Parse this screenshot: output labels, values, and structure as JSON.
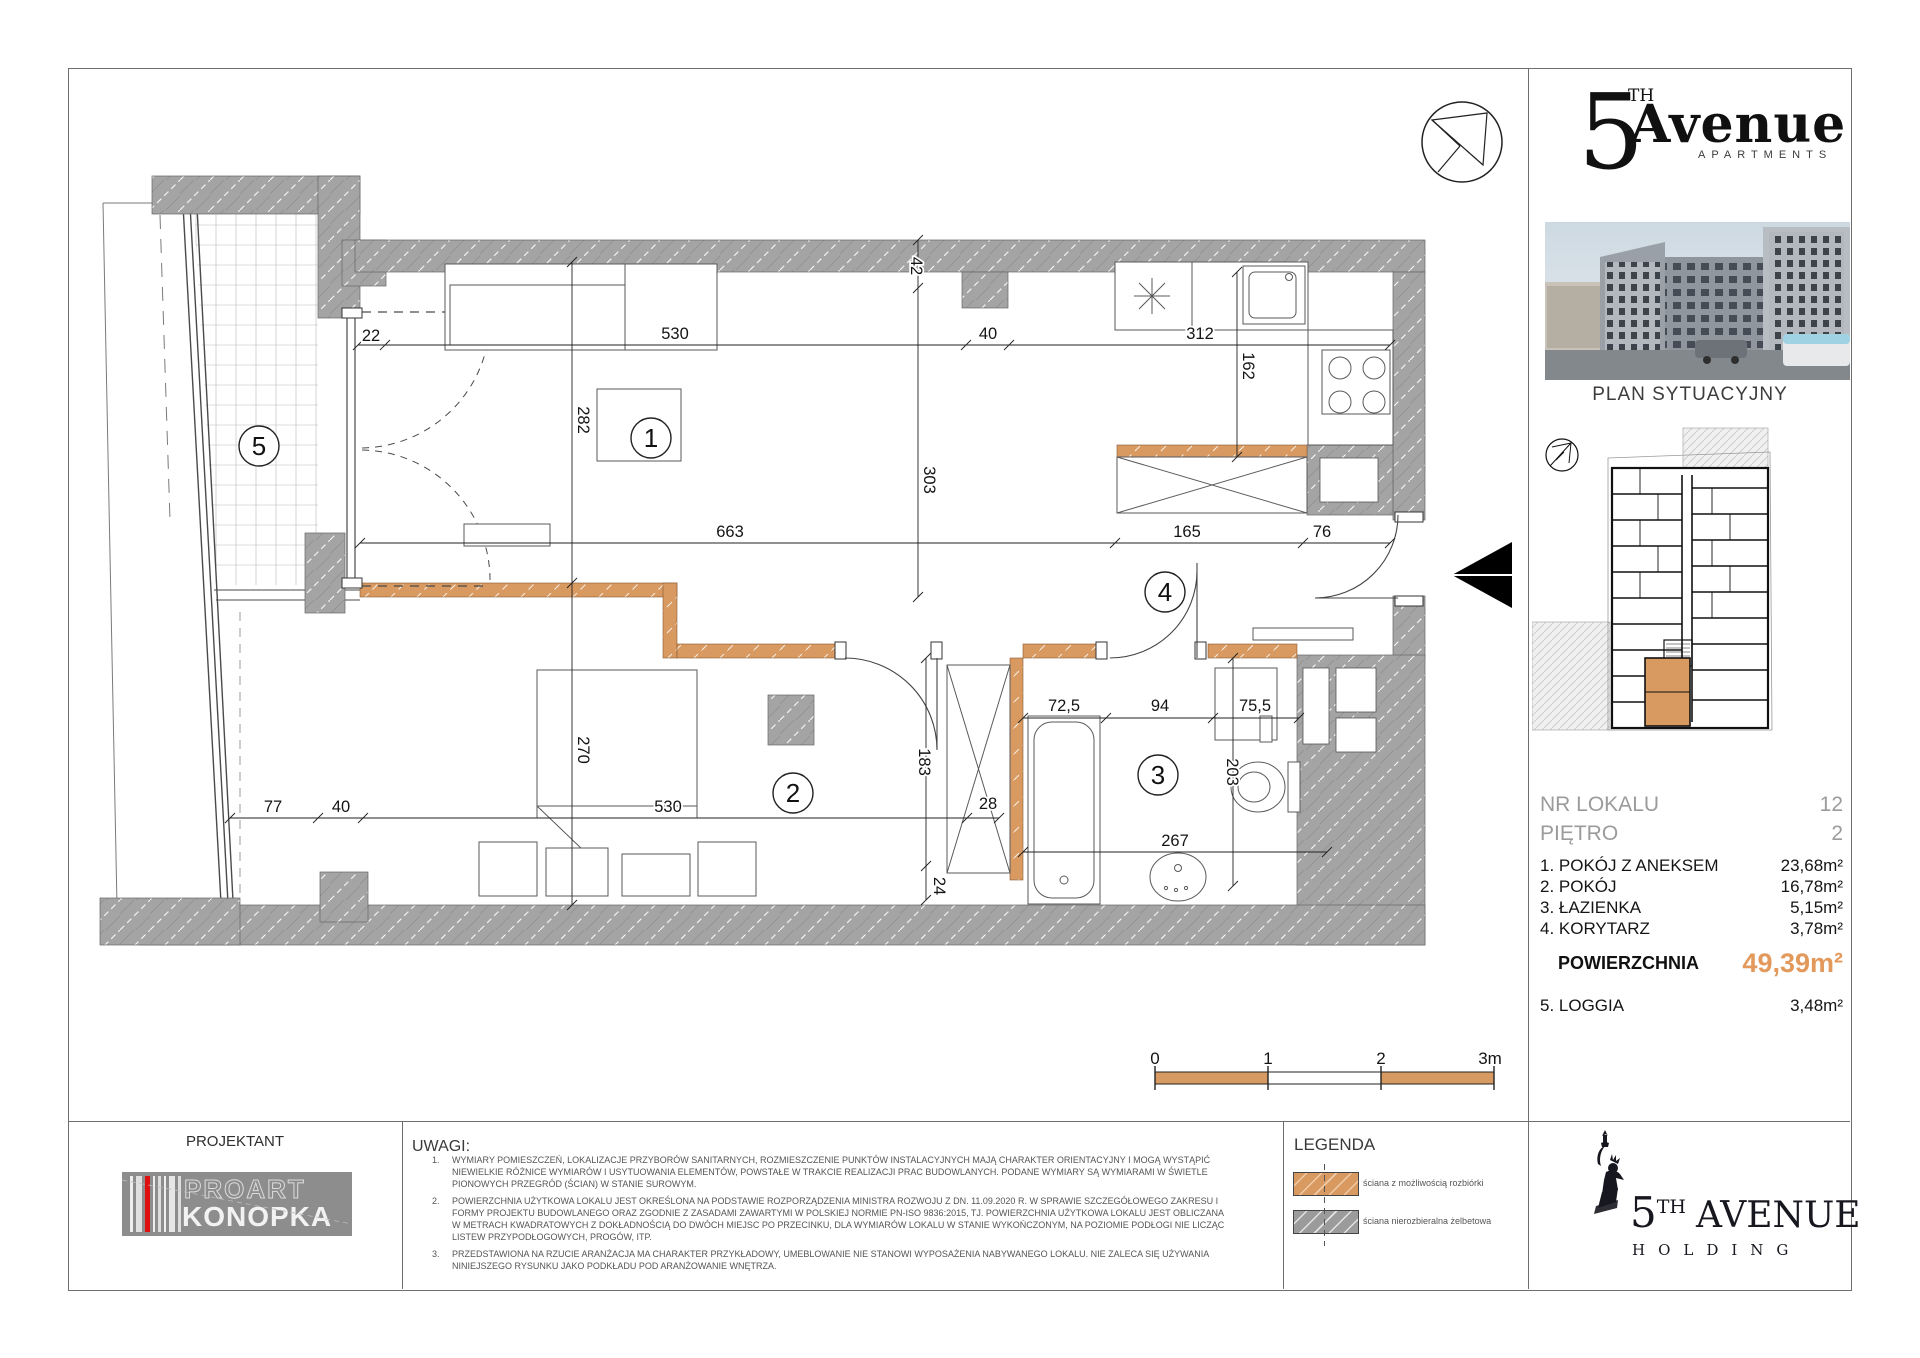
{
  "plan": {
    "rooms": [
      "1",
      "2",
      "3",
      "4",
      "5"
    ],
    "dims": {
      "t22": "22",
      "t530": "530",
      "t40": "40",
      "t312": "312",
      "v42": "42",
      "v303": "303",
      "v282": "282",
      "v270": "270",
      "v162": "162",
      "m663": "663",
      "m165": "165",
      "m76": "76",
      "b77": "77",
      "b40": "40",
      "b530": "530",
      "b28": "28",
      "bath725": "72,5",
      "bath94": "94",
      "bath755": "75,5",
      "v183": "183",
      "v203": "203",
      "b267": "267",
      "v24": "24"
    },
    "scale": [
      "0",
      "1",
      "2",
      "3m"
    ]
  },
  "panel": {
    "apartments_logo": {
      "five": "5",
      "th": "TH",
      "word": "Avenue",
      "sub": "APARTMENTS"
    },
    "site_plan_title": "PLAN SYTUACYJNY",
    "unit": {
      "nr_label": "NR LOKALU",
      "nr_value": "12",
      "floor_label": "PIĘTRO",
      "floor_value": "2"
    },
    "rooms": [
      {
        "name": "1. POKÓJ Z ANEKSEM",
        "area": "23,68m²"
      },
      {
        "name": "2. POKÓJ",
        "area": "16,78m²"
      },
      {
        "name": "3. ŁAZIENKA",
        "area": "5,15m²"
      },
      {
        "name": "4. KORYTARZ",
        "area": "3,78m²"
      }
    ],
    "total": {
      "label": "POWIERZCHNIA",
      "value": "49,39m²"
    },
    "loggia": {
      "name": "5. LOGGIA",
      "area": "3,48m²"
    }
  },
  "footer": {
    "projektant": "PROJEKTANT",
    "proart": {
      "top": "PROART",
      "bottom": "KONOPKA"
    },
    "uwagi_title": "UWAGI:",
    "notes": [
      {
        "num": "1.",
        "lines": [
          "WYMIARY POMIESZCZEŃ, LOKALIZACJE PRZYBORÓW SANITARNYCH, ROZMIESZCZENIE PUNKTÓW INSTALACYJNYCH MAJĄ CHARAKTER ORIENTACYJNY I MOGĄ WYSTĄPIĆ",
          "NIEWIELKIE RÓŻNICE WYMIARÓW I USYTUOWANIA ELEMENTÓW, POWSTAŁE W TRAKCIE REALIZACJI PRAC BUDOWLANYCH. PODANE WYMIARY SĄ WYMIARAMI W ŚWIETLE",
          "PIONOWYCH PRZEGRÓD (ŚCIAN) W STANIE SUROWYM."
        ]
      },
      {
        "num": "2.",
        "lines": [
          "POWIERZCHNIA UŻYTKOWA LOKALU JEST OKREŚLONA NA PODSTAWIE ROZPORZĄDZENIA MINISTRA ROZWOJU Z DN. 11.09.2020 R. W SPRAWIE SZCZEGÓŁOWEGO ZAKRESU I",
          "FORMY PROJEKTU BUDOWLANEGO ORAZ ZGODNIE Z ZASADAMI ZAWARTYMI W POLSKIEJ NORMIE PN-ISO 9836:2015, TJ. POWIERZCHNIA UŻYTKOWA LOKALU JEST OBLICZANA",
          "W METRACH KWADRATOWYCH Z DOKŁADNOŚCIĄ DO DWÓCH MIEJSC PO PRZECINKU, DLA WYMIARÓW LOKALU W STANIE WYKOŃCZONYM, NA POZIOMIE PODŁOGI NIE LICZĄC",
          "LISTEW PRZYPODŁOGOWYCH, PROGÓW, ITP."
        ]
      },
      {
        "num": "3.",
        "lines": [
          "PRZEDSTAWIONA NA RZUCIE ARANŻACJA MA CHARAKTER PRZYKŁADOWY, UMEBLOWANIE NIE STANOWI WYPOSAŻENIA NABYWANEGO LOKALU. NIE ZALECA SIĘ UŻYWANIA",
          "NINIEJSZEGO RYSUNKU JAKO PODKŁADU POD ARANŻOWANIE WNĘTRZA."
        ]
      }
    ],
    "legend": {
      "title": "LEGENDA",
      "items": [
        {
          "label": "ściana z możliwością rozbiórki",
          "color": "#d89a61"
        },
        {
          "label": "ściana nierozbieralna żelbetowa",
          "color": "#9b9b9b"
        }
      ]
    },
    "holding": {
      "five": "5",
      "th": "TH",
      "word": "AVENUE",
      "sub": "HOLDING"
    }
  },
  "colors": {
    "removable_wall": "#d89a61",
    "concrete_wall": "#a4a4a4",
    "area_accent": "#e2995b"
  }
}
